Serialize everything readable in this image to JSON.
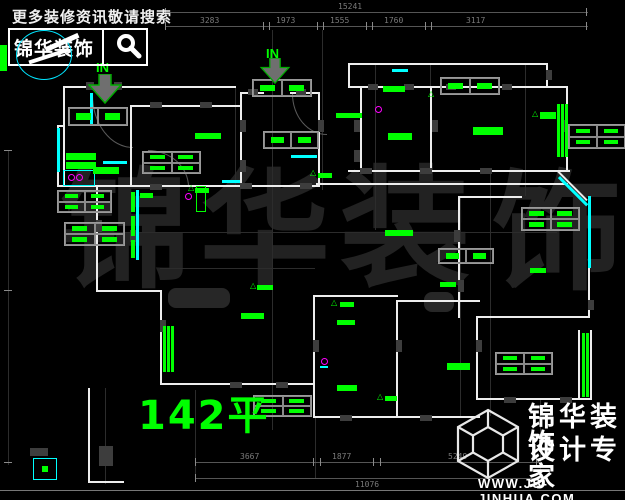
{
  "header": {
    "search_text": "更多装修资讯敬请搜索",
    "logo_text": "锦华装饰",
    "search_icon": "magnifier-icon"
  },
  "watermark": {
    "chars": [
      "锦",
      "华",
      "装",
      "饰"
    ]
  },
  "plan": {
    "in_label": "IN",
    "entrance_icon": "down-arrow-icon",
    "area_label": "142平"
  },
  "dims": {
    "top": {
      "total": "15241",
      "segments": [
        "3283",
        "1973",
        "1555",
        "1760",
        "3117"
      ]
    },
    "bottom": {
      "segments": [
        "3667",
        "1877",
        "5249"
      ],
      "total": "11076"
    }
  },
  "footer": {
    "line1": "锦华装饰",
    "line2": "设计专家",
    "website": "WWW.JS-JINHUA.COM",
    "logo_icon": "cube-wireframe-icon"
  },
  "colors": {
    "background": "#000000",
    "wall": "#ededed",
    "window": "#00ffff",
    "label": "#00ff00",
    "dimension": "#7a7a7a",
    "watermark": "#222222",
    "accent_magenta": "#ff00ff"
  }
}
